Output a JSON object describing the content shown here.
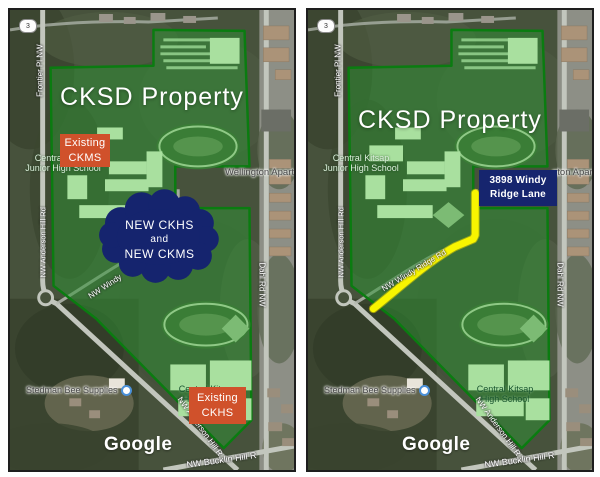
{
  "left": {
    "badge": "3",
    "title": "CKSD Property",
    "watermark": "Google",
    "roads": {
      "frontier": "Frontier Pl NW",
      "west": "NW Anderson Hill Rd",
      "windy": "NW Windy",
      "dahl": "Dahl Rd NW",
      "anderson": "NW Anderson Hill R",
      "bucklin": "NW Bucklin Hill R"
    },
    "places": {
      "jhs_line1": "Central Kitsap",
      "jhs_line2": "Junior High School",
      "wellington": "Wellington Apart",
      "stedman": "Stedman Bee Supplies",
      "hs_line1": "Central Kitsap",
      "hs_line2": "High School"
    },
    "callouts": {
      "ckms": {
        "line1": "Existing",
        "line2": "CKMS"
      },
      "ckhs": {
        "line1": "Existing",
        "line2": "CKHS"
      },
      "cloud": {
        "line1": "NEW CKHS",
        "line2": "and",
        "line3": "NEW CKMS"
      }
    }
  },
  "right": {
    "badge": "3",
    "title": "CKSD Property",
    "watermark": "Google",
    "roads": {
      "frontier": "Frontier Pl NW",
      "west": "NW Anderson Hill Rd",
      "windy": "NW Windy Ridge Rd",
      "dahl": "Dahl Rd NW",
      "anderson": "NW Anderson Hill R",
      "bucklin": "NW Bucklin Hill R"
    },
    "places": {
      "jhs_line1": "Central Kitsap",
      "jhs_line2": "Junior High School",
      "wellington": "gton Apart",
      "stedman": "Stedman Bee Supplies",
      "hs_line1": "Central Kitsap",
      "hs_line2": "High School"
    },
    "address": {
      "line1": "3898 Windy",
      "line2": "Ridge Lane"
    }
  },
  "colors": {
    "property_fill": "#2e9433",
    "property_border": "#0a7c10",
    "callout_orange": "#d0512b",
    "callout_navy": "#16256e",
    "route_yellow": "#f8f500"
  }
}
